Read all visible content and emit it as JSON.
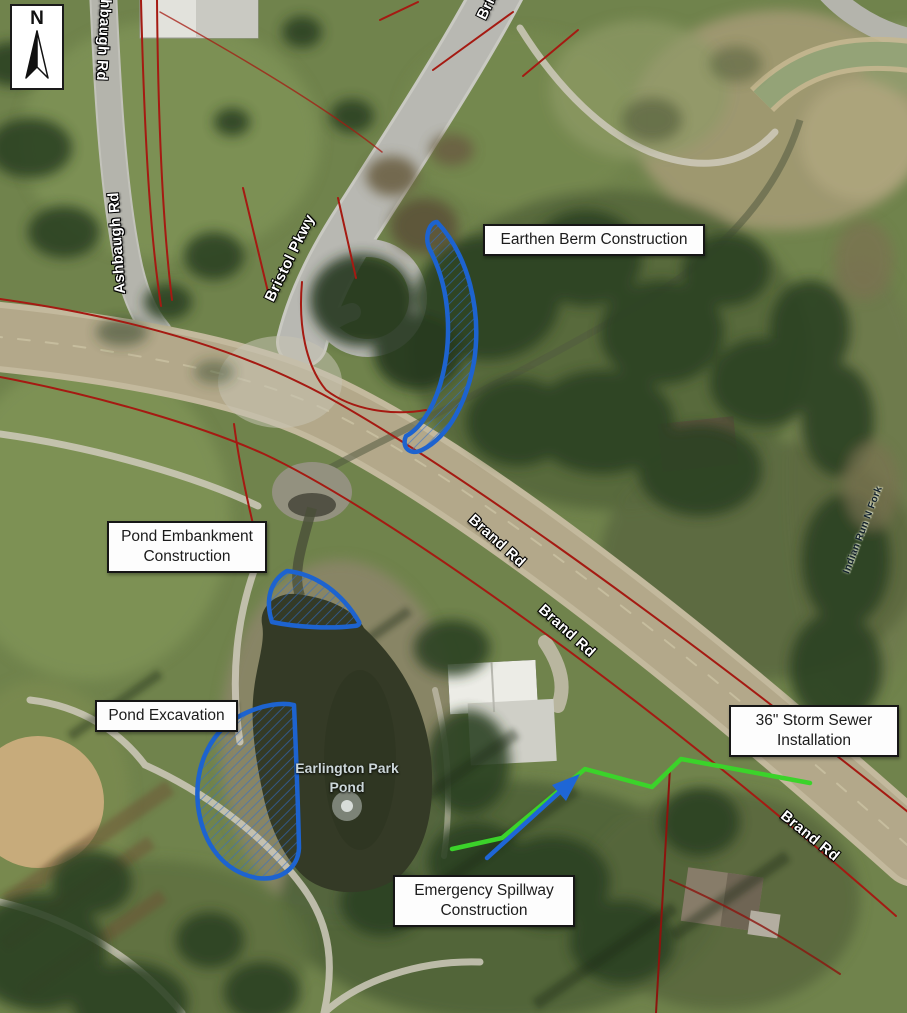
{
  "map": {
    "compass": {
      "north_label": "N"
    },
    "callouts": [
      {
        "id": "earthen-berm",
        "label": "Earthen Berm Construction"
      },
      {
        "id": "pond-embankment",
        "label": "Pond Embankment Construction"
      },
      {
        "id": "pond-excavation",
        "label": "Pond Excavation"
      },
      {
        "id": "storm-sewer",
        "label": "36\" Storm Sewer Installation"
      },
      {
        "id": "emergency-spillway",
        "label": "Emergency Spillway Construction"
      }
    ],
    "road_labels": [
      {
        "id": "ashbaugh-rd-north",
        "label": "Ashbaugh Rd"
      },
      {
        "id": "ashbaugh-rd",
        "label": "Ashbaugh Rd"
      },
      {
        "id": "bristol-pkwy-north",
        "label": "Bristol Pkwy"
      },
      {
        "id": "bristol-pkwy",
        "label": "Bristol Pkwy"
      },
      {
        "id": "brand-rd-1",
        "label": "Brand Rd"
      },
      {
        "id": "brand-rd-2",
        "label": "Brand Rd"
      },
      {
        "id": "brand-rd-3",
        "label": "Brand Rd"
      }
    ],
    "water_labels": [
      {
        "id": "earlington-park-pond",
        "label": "Earlington Park Pond"
      },
      {
        "id": "indian-run-n-fork",
        "label": "Indian Run N Fork"
      }
    ],
    "annotation_colors": {
      "construction_area_outline": "#1d63cf",
      "storm_sewer_line": "#3bd32a",
      "spillway_arrow": "#1e66d6",
      "parcel_boundary": "#a51a12"
    }
  }
}
